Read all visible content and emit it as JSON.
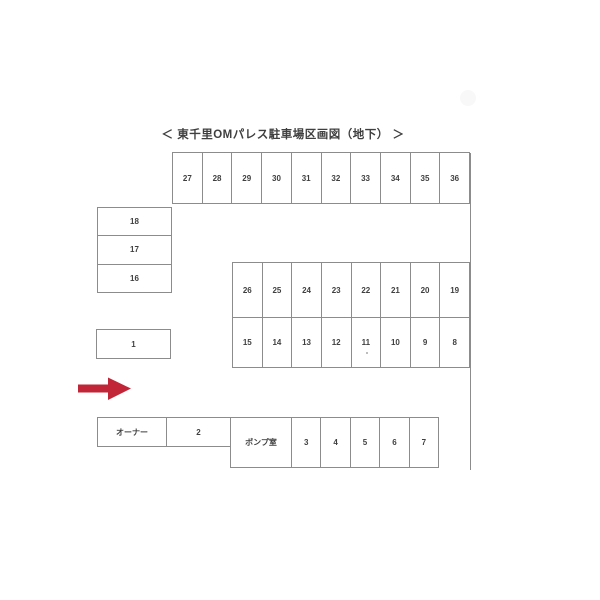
{
  "title": "＜ 東千里OMパレス駐車場区画図（地下） ＞",
  "colors": {
    "line": "#8c8c8c",
    "ink": "#3f3f3f",
    "arrow_red": "#c22537",
    "paper": "#ffffff"
  },
  "spaces": {
    "top_row": [
      "27",
      "28",
      "29",
      "30",
      "31",
      "32",
      "33",
      "34",
      "35",
      "36"
    ],
    "left_column": [
      "18",
      "17",
      "16"
    ],
    "middle_grid_row1": [
      "26",
      "25",
      "24",
      "23",
      "22",
      "21",
      "20",
      "19"
    ],
    "middle_grid_row2": [
      "15",
      "14",
      "13",
      "12",
      "11",
      "10",
      "9",
      "8"
    ],
    "single": "1",
    "owner_row": [
      "オーナー",
      "2"
    ],
    "pump_row": [
      "ポンプ室",
      "3",
      "4",
      "5",
      "6",
      "7"
    ]
  },
  "arrow": {
    "color": "#c22537",
    "direction": "right"
  }
}
